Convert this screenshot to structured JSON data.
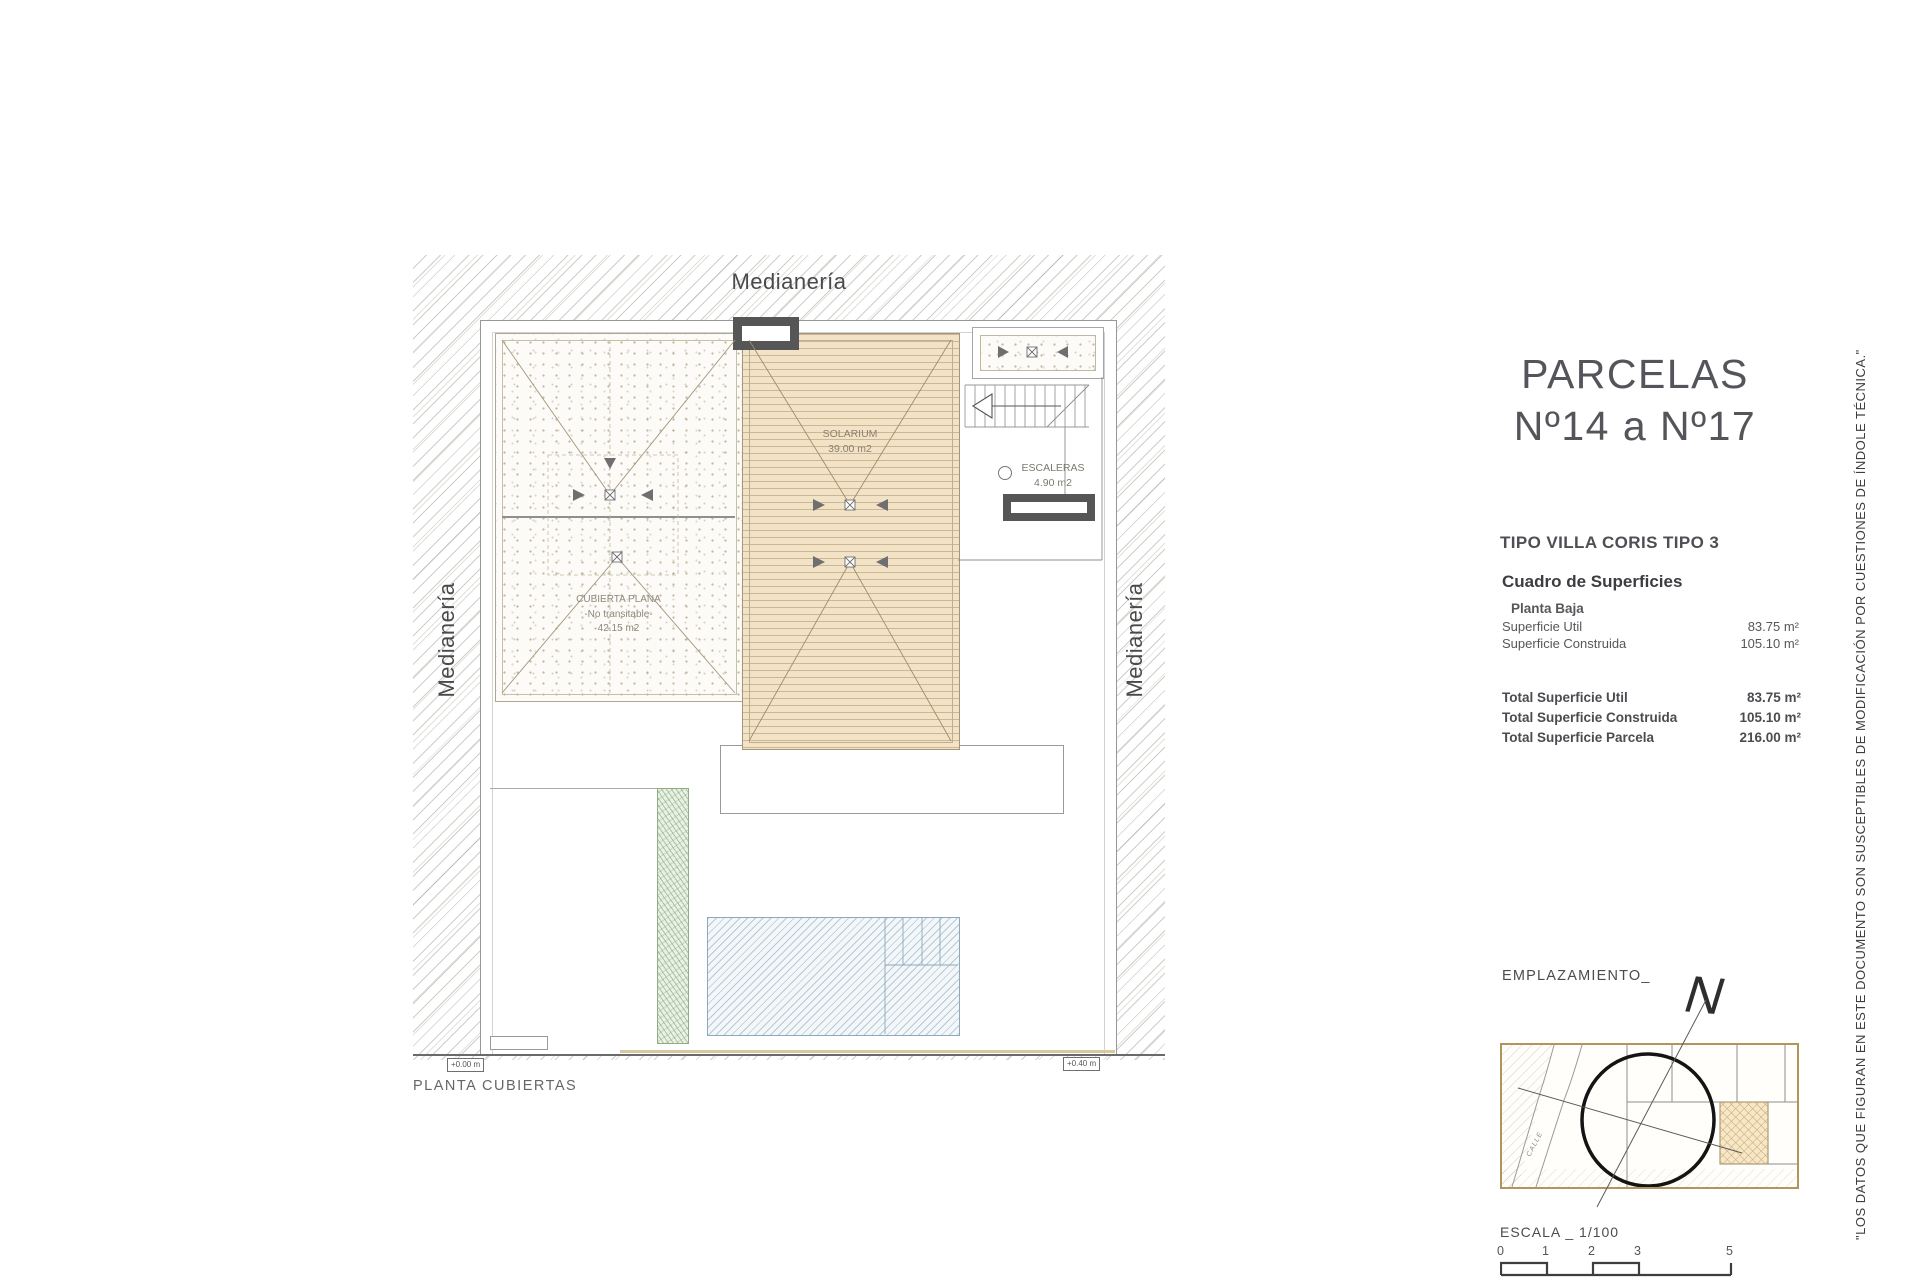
{
  "sheet": {
    "title_line1": "PARCELAS",
    "title_line2": "Nº14 a Nº17",
    "tipo": "TIPO VILLA CORIS TIPO 3",
    "cuadro_title": "Cuadro de Superficies",
    "planta_baja_label": "Planta Baja",
    "superficies": [
      {
        "label": "Superficie Util",
        "value": "83.75 m²"
      },
      {
        "label": "Superficie Construida",
        "value": "105.10 m²"
      }
    ],
    "totales": [
      {
        "label": "Total Superficie Util",
        "value": "83.75 m²"
      },
      {
        "label": "Total Superficie Construida",
        "value": "105.10 m²"
      },
      {
        "label": "Total Superficie Parcela",
        "value": "216.00 m²"
      }
    ],
    "disclaimer": "\"LOS DATOS QUE FIGURAN EN ESTE DOCUMENTO SON SUSCEPTIBLES DE MODIFICACIÓN POR CUESTIONES DE ÍNDOLE TÉCNICA.\""
  },
  "plan": {
    "caption": "PLANTA CUBIERTAS",
    "medianeria_top": "Medianería",
    "medianeria_left": "Medianería",
    "medianeria_right": "Medianería",
    "solarium_name": "SOLARIUM",
    "solarium_area": "39.00 m2",
    "cubierta_name": "CUBIERTA PLANA",
    "cubierta_sub": "-No transitable-",
    "cubierta_area": "42.15 m2",
    "escaleras_name": "ESCALERAS",
    "escaleras_area": "4.90 m2",
    "level_left": "+0.00 m",
    "level_right": "+0.40 m"
  },
  "emplazamiento": {
    "label": "EMPLAZAMIENTO_",
    "north_label": "N",
    "street_label": "CALLE"
  },
  "escala": {
    "label": "ESCALA _ 1/100",
    "ticks": [
      "0",
      "1",
      "2",
      "3",
      "5"
    ]
  },
  "colors": {
    "solarium_tan": "#f2e3c7",
    "map_border": "#b49559",
    "chimney_gray": "#565656",
    "pool_blue": "#8da8ba",
    "hedge_green": "#93ab87",
    "text_dark": "#4a4b4f"
  }
}
